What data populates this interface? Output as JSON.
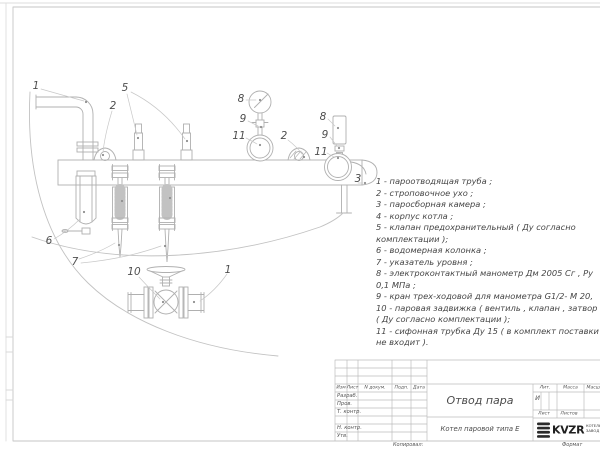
{
  "sheet": {
    "bg": "#ffffff",
    "line_color": "#b0b0b0",
    "text_color": "#4a4a4a"
  },
  "drawing": {
    "labels": [
      "1",
      "2",
      "5",
      "8",
      "9",
      "11",
      "2",
      "8",
      "9",
      "11",
      "3",
      "6",
      "7",
      "10",
      "1"
    ]
  },
  "legend": {
    "lines": [
      "1 -  пароотводящая труба ;",
      "2 -  строповочное ухо ;",
      "3 -  паросборная камера ;",
      "4 -  корпус котла ;",
      "5 -  клапан предохранительный  ( Ду согласно",
      "комплектации );",
      "6 -  водомерная колонка ;",
      "7 - указатель уровня ;",
      "8 - электроконтактный манометр  Дм 2005 Сг ,  Ру",
      "0,1  МПа ;",
      "9 -  кран трех-ходовой для манометра  G1/2- М 20,",
      "10 -  паровая задвижка  ( вентиль , клапан , затвор",
      "( Ду согласно комплектации );",
      "11 -  сифонная трубка Ду 15 ( в комплект поставки",
      "не входит )."
    ]
  },
  "titleblock": {
    "col_izm": "Изм",
    "col_list": "Лист",
    "col_ndokum": "N докум.",
    "col_podp": "Подп.",
    "col_data": "Дата",
    "row_razrab": "Разраб.",
    "row_prov": "Пров.",
    "row_tkontr": "Т. контр.",
    "row_nkontr": "Н. контр.",
    "row_utv": "Утв.",
    "title": "Отвод пара",
    "subtitle": "Котел паровой типа Е",
    "lit_label": "Лит.",
    "massa_label": "Масса",
    "masshtab_label": "Масштаб",
    "lit_value": "И",
    "list_label": "Лист",
    "listov_label": "Листов",
    "logo_text": "KVZR",
    "logo_line1": "КОТЕЛЬНЫЙ",
    "logo_line2": "ЗАВОД Р"
  },
  "footer": {
    "kopiroval": "Копировал:",
    "format_label": "Формат"
  }
}
